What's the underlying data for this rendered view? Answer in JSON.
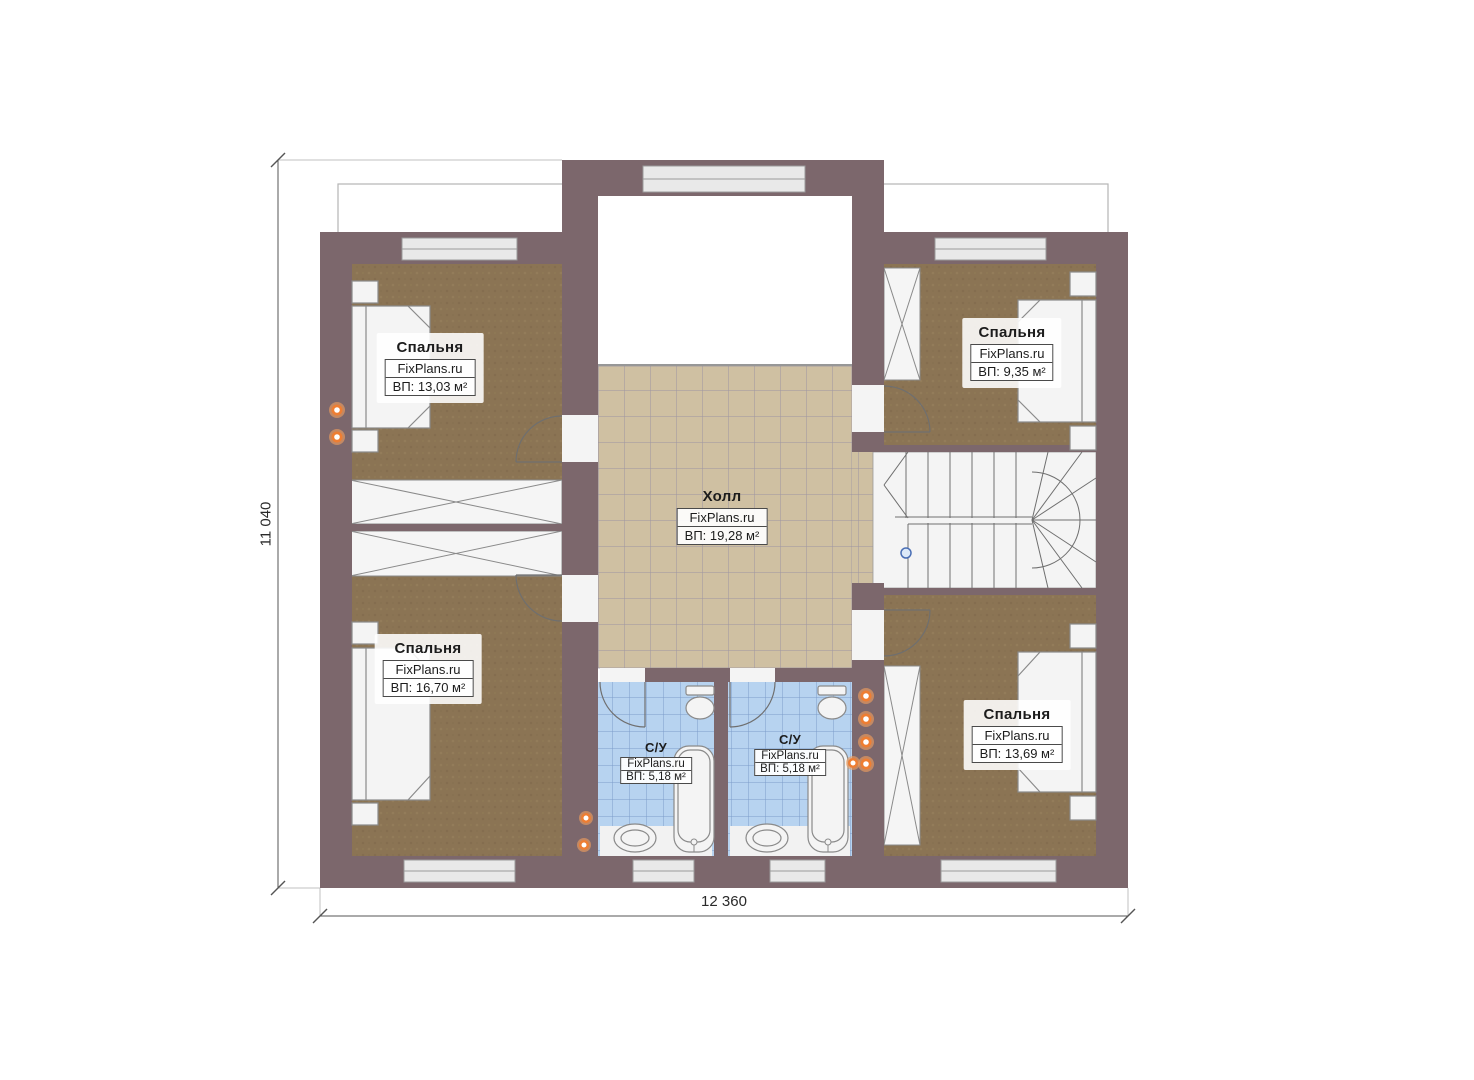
{
  "plan": {
    "brand": "FixPlans.ru",
    "dimensions": {
      "height_label": "11 040",
      "width_label": "12 360"
    },
    "rooms": [
      {
        "id": "bedroom-top-left",
        "name": "Спальня",
        "brand": "FixPlans.ru",
        "area": "ВП: 13,03 м²"
      },
      {
        "id": "bedroom-top-right",
        "name": "Спальня",
        "brand": "FixPlans.ru",
        "area": "ВП: 9,35 м²"
      },
      {
        "id": "bedroom-bottom-left",
        "name": "Спальня",
        "brand": "FixPlans.ru",
        "area": "ВП: 16,70 м²"
      },
      {
        "id": "bedroom-bottom-right",
        "name": "Спальня",
        "brand": "FixPlans.ru",
        "area": "ВП: 13,69 м²"
      },
      {
        "id": "hall",
        "name": "Холл",
        "brand": "FixPlans.ru",
        "area": "ВП: 19,28 м²"
      },
      {
        "id": "bathroom-1",
        "name": "С/У",
        "brand": "FixPlans.ru",
        "area": "ВП: 5,18 м²"
      },
      {
        "id": "bathroom-2",
        "name": "С/У",
        "brand": "FixPlans.ru",
        "area": "ВП: 5,18 м²"
      }
    ],
    "colors": {
      "wall": "#7c676c",
      "bedroom_floor": "#8b7454",
      "hall_floor": "#cfc0a2",
      "bathroom_floor": "#b7d3f0",
      "fixture_fill": "#f4f4f4",
      "accent_orange": "#ee7e33",
      "stair_marker_blue": "#4a6fb5"
    }
  }
}
